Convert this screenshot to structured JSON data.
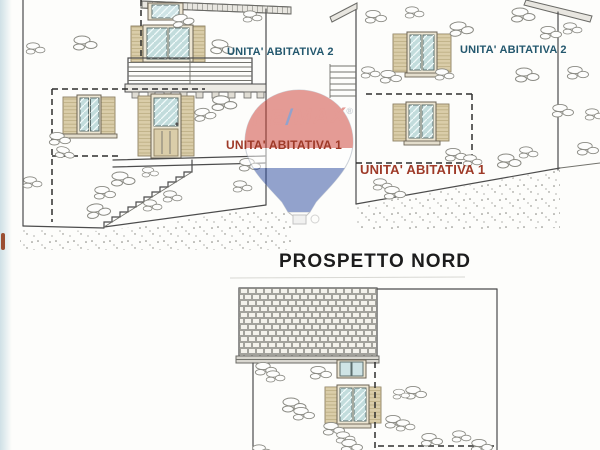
{
  "title": "PROSPETTO NORD",
  "elevations": {
    "top_left": {
      "unit2": "UNITA' ABITATIVA 2",
      "unit1": "UNITA' ABITATIVA 1"
    },
    "top_right": {
      "unit2": "UNITA' ABITATIVA 2",
      "unit1": "UNITA' ABITATIVA 1"
    }
  },
  "watermark": {
    "brand_left": "RE",
    "brand_slash": "/",
    "brand_right": "MAX",
    "registered": "®"
  },
  "colors": {
    "unit1_label": "#9e3a28",
    "unit2_label": "#24586e",
    "remax_red": "#cc3b31",
    "remax_blue": "#2a4a9e",
    "glass": "#c2dcdc",
    "shutter_wood": "#dacda9",
    "drawing_line": "#4c4c4c"
  }
}
